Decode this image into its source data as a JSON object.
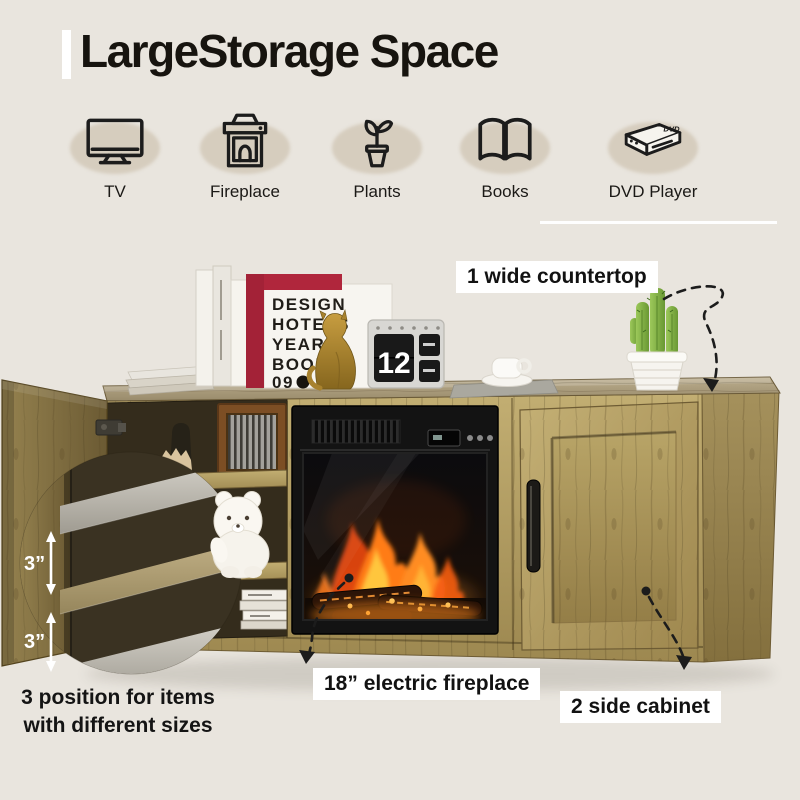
{
  "title": "LargeStorage Space",
  "features": [
    {
      "label": "TV"
    },
    {
      "label": "Fireplace"
    },
    {
      "label": "Plants"
    },
    {
      "label": "Books"
    },
    {
      "label": "DVD Player",
      "badge": "DVD"
    }
  ],
  "annotations": {
    "countertop": "1 wide countertop",
    "fireplace": "18” electric fireplace",
    "side_cabinet": "2 side cabinet",
    "shelf_line1": "3 position for items",
    "shelf_line2": "with different sizes",
    "gap_top": "3”",
    "gap_bottom": "3”"
  },
  "decor": {
    "book_title_lines": [
      "DESIGN",
      "HOTELS",
      "YEAR",
      "BOOK",
      "09"
    ],
    "calendar_day": "12"
  },
  "colors": {
    "background": "#e9e5de",
    "icon_ellipse": "#d6cdbe",
    "ink": "#17140f",
    "note_bg": "#ffffff",
    "wood_light": "#c0ad72",
    "wood_dark": "#6d5c33",
    "flame_orange": "#ff7c16",
    "red_book": "#b0263c",
    "cactus_green": "#7fae45"
  }
}
